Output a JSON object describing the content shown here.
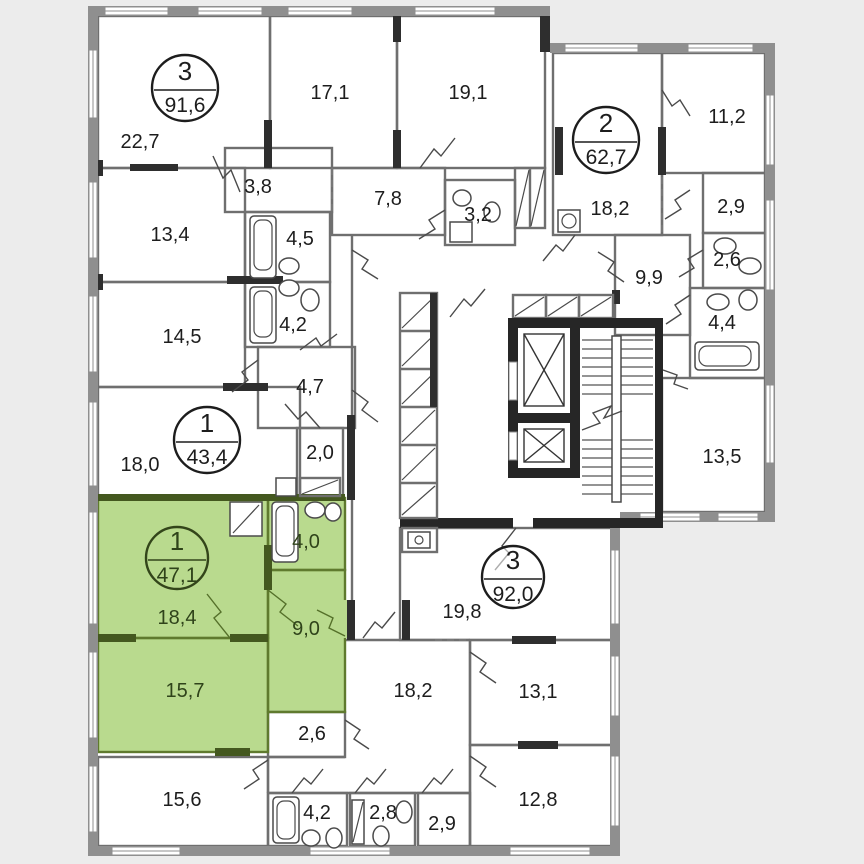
{
  "plan": {
    "title": "apartment-floor-plan",
    "colors": {
      "highlight_fill": "#b9da8e",
      "highlight_wall": "#44581f",
      "exterior_wall": "#8f8f8f",
      "structural_wall": "#2e2e2e",
      "background": "#ececec"
    },
    "apartments": [
      {
        "rooms_count": "3",
        "total_area": "91,6",
        "highlighted": false
      },
      {
        "rooms_count": "2",
        "total_area": "62,7",
        "highlighted": false
      },
      {
        "rooms_count": "1",
        "total_area": "43,4",
        "highlighted": false
      },
      {
        "rooms_count": "1",
        "total_area": "47,1",
        "highlighted": true
      },
      {
        "rooms_count": "3",
        "total_area": "92,0",
        "highlighted": false
      }
    ],
    "rooms": [
      {
        "id": "room-22-7",
        "area": "22,7"
      },
      {
        "id": "room-17-1",
        "area": "17,1"
      },
      {
        "id": "room-19-1",
        "area": "19,1"
      },
      {
        "id": "room-3-8",
        "area": "3,8"
      },
      {
        "id": "room-13-4",
        "area": "13,4"
      },
      {
        "id": "room-4-5",
        "area": "4,5"
      },
      {
        "id": "room-7-8",
        "area": "7,8"
      },
      {
        "id": "room-3-2",
        "area": "3,2"
      },
      {
        "id": "room-18-2-a",
        "area": "18,2"
      },
      {
        "id": "room-11-2",
        "area": "11,2"
      },
      {
        "id": "room-2-9-a",
        "area": "2,9"
      },
      {
        "id": "room-2-6-a",
        "area": "2,6"
      },
      {
        "id": "room-9-9",
        "area": "9,9"
      },
      {
        "id": "room-4-4",
        "area": "4,4"
      },
      {
        "id": "room-13-5",
        "area": "13,5"
      },
      {
        "id": "room-14-5",
        "area": "14,5"
      },
      {
        "id": "room-4-2-t",
        "area": "4,2"
      },
      {
        "id": "room-4-7",
        "area": "4,7"
      },
      {
        "id": "room-18-0",
        "area": "18,0"
      },
      {
        "id": "room-2-0",
        "area": "2,0"
      },
      {
        "id": "room-18-4",
        "area": "18,4"
      },
      {
        "id": "room-9-0",
        "area": "9,0"
      },
      {
        "id": "room-15-7",
        "area": "15,7"
      },
      {
        "id": "room-4-0",
        "area": "4,0"
      },
      {
        "id": "room-2-6-w",
        "area": "2,6"
      },
      {
        "id": "room-19-8",
        "area": "19,8"
      },
      {
        "id": "room-18-2-b",
        "area": "18,2"
      },
      {
        "id": "room-13-1",
        "area": "13,1"
      },
      {
        "id": "room-12-8",
        "area": "12,8"
      },
      {
        "id": "room-15-6",
        "area": "15,6"
      },
      {
        "id": "room-4-2-b",
        "area": "4,2"
      },
      {
        "id": "room-2-8",
        "area": "2,8"
      },
      {
        "id": "room-2-9-b",
        "area": "2,9"
      }
    ]
  }
}
